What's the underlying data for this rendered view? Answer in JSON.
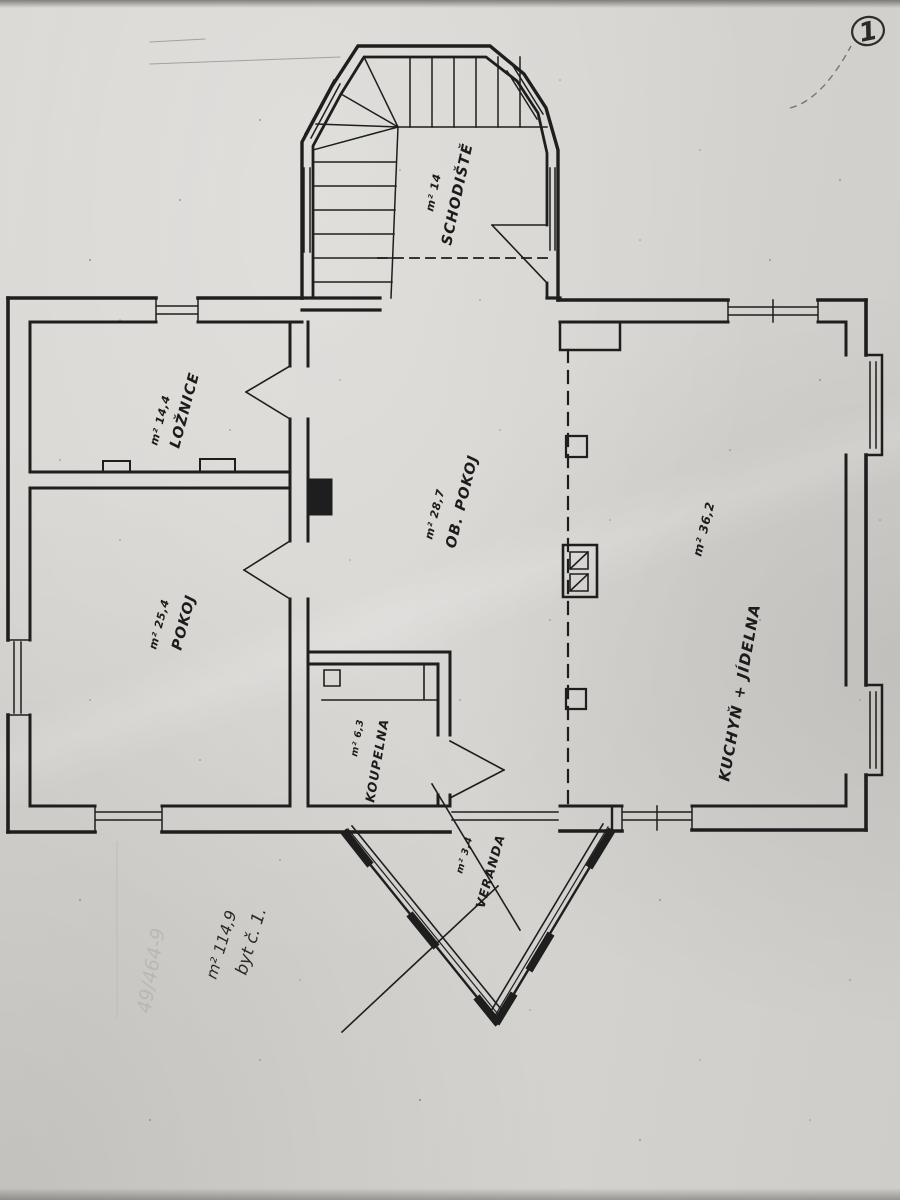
{
  "rooms": {
    "schodiste": {
      "name": "SCHODIŠTĚ",
      "area": "m² 14"
    },
    "loznice": {
      "name": "LOŽNICE",
      "area": "m² 14,4"
    },
    "ob_pokoj": {
      "name": "OB. POKOJ",
      "area": "m² 28,7"
    },
    "kuchyn_jidelna": {
      "name": "KUCHYŇ + JÍDELNA",
      "area": "m² 36,2"
    },
    "pokoj": {
      "name": "POKOJ",
      "area": "m² 25,4"
    },
    "koupelna": {
      "name": "KOUPELNA",
      "area": "m² 6,3"
    },
    "veranda": {
      "name": "VERANDA",
      "area": "m² 3,4"
    }
  },
  "annotations": {
    "page_number": "1",
    "apartment_line1": "byt č. 1.",
    "apartment_line2": "m² 114,9",
    "pencil_note": "49/464-9"
  },
  "colors": {
    "paper": "#d6d4d0",
    "ink": "#1e1e1e",
    "pencil": "#b4b2ae"
  }
}
